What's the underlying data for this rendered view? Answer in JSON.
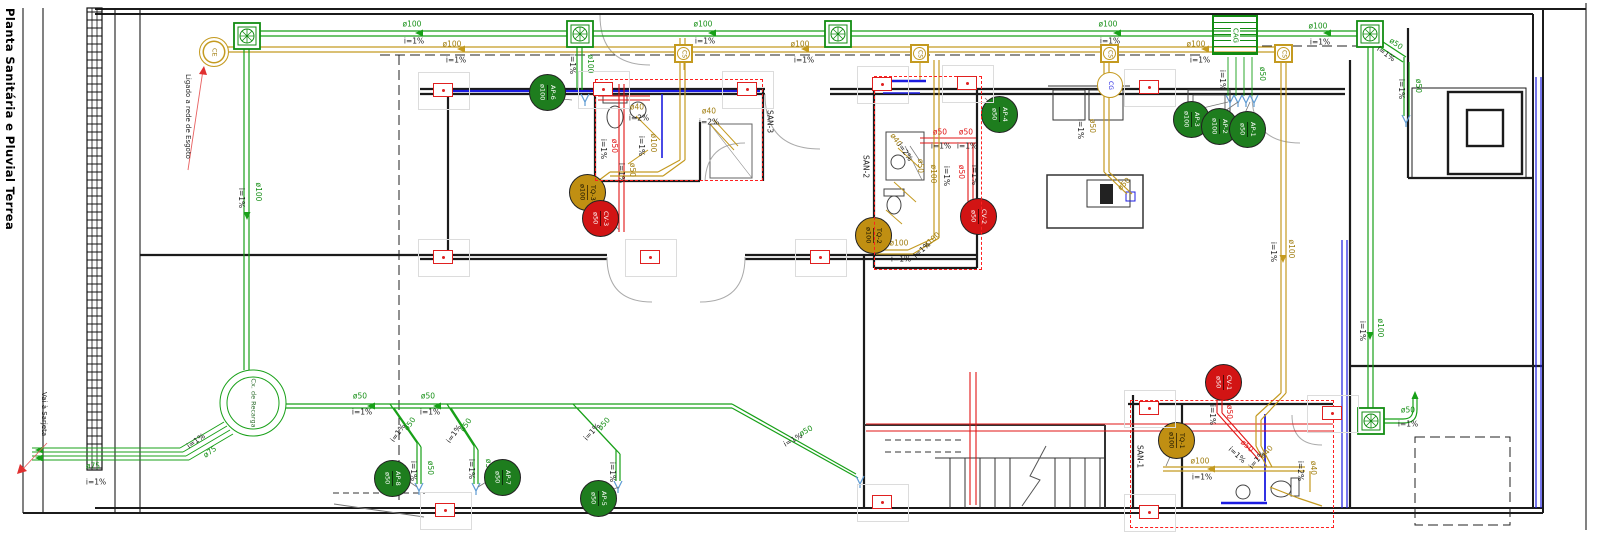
{
  "title": "Planta Sanitária e Pluvial Terrea",
  "notes": {
    "ligado": "Ligado a rede de Esgoto",
    "vai_sarjeta": "Vai à Sarjeta"
  },
  "symbols": {
    "ce": "CE",
    "cag": "CAG",
    "cg": "CG",
    "cs": "CS",
    "cx_recarga": "Cx. de Recarga",
    "cs_boxes": [
      {
        "x": 684
      },
      {
        "x": 920
      },
      {
        "x": 1110
      },
      {
        "x": 1284
      }
    ]
  },
  "rooms": [
    {
      "id": "SAN-3",
      "x1": 595,
      "y1": 79,
      "x2": 763,
      "y2": 181,
      "lx": 766,
      "ly": 110
    },
    {
      "id": "SAN-2",
      "x1": 874,
      "y1": 76,
      "x2": 982,
      "y2": 270,
      "lx": 862,
      "ly": 155
    },
    {
      "id": "SAN-1",
      "x1": 1130,
      "y1": 400,
      "x2": 1334,
      "y2": 528,
      "lx": 1136,
      "ly": 445
    }
  ],
  "badges": [
    {
      "id": "AP-6",
      "dia": "ø100",
      "kind": "ap",
      "x": 547,
      "y": 92
    },
    {
      "id": "AP-4",
      "dia": "ø50",
      "kind": "ap",
      "x": 999,
      "y": 114
    },
    {
      "id": "AP-3",
      "dia": "ø100",
      "kind": "ap",
      "x": 1191,
      "y": 119
    },
    {
      "id": "AP-2",
      "dia": "ø100",
      "kind": "ap",
      "x": 1219,
      "y": 126
    },
    {
      "id": "AP-1",
      "dia": "ø50",
      "kind": "ap",
      "x": 1247,
      "y": 129
    },
    {
      "id": "AP-8",
      "dia": "ø50",
      "kind": "ap",
      "x": 392,
      "y": 478
    },
    {
      "id": "AP-7",
      "dia": "ø50",
      "kind": "ap",
      "x": 502,
      "y": 477
    },
    {
      "id": "AP-5",
      "dia": "ø50",
      "kind": "ap",
      "x": 598,
      "y": 498
    },
    {
      "id": "TQ-3",
      "dia": "ø100",
      "kind": "tq",
      "x": 587,
      "y": 192
    },
    {
      "id": "TQ-2",
      "dia": "ø100",
      "kind": "tq",
      "x": 873,
      "y": 235
    },
    {
      "id": "TQ-1",
      "dia": "ø100",
      "kind": "tq",
      "x": 1176,
      "y": 440
    },
    {
      "id": "CV-3",
      "dia": "ø50",
      "kind": "cv",
      "x": 600,
      "y": 218
    },
    {
      "id": "CV-2",
      "dia": "ø50",
      "kind": "cv",
      "x": 978,
      "y": 216
    },
    {
      "id": "CV-1",
      "dia": "ø50",
      "kind": "cv",
      "x": 1223,
      "y": 382
    }
  ],
  "markers": [
    {
      "x": 443,
      "y": 90
    },
    {
      "x": 1149,
      "y": 87
    },
    {
      "x": 443,
      "y": 257
    },
    {
      "x": 650,
      "y": 257
    },
    {
      "x": 820,
      "y": 257
    },
    {
      "x": 603,
      "y": 89
    },
    {
      "x": 747,
      "y": 89
    },
    {
      "x": 882,
      "y": 84
    },
    {
      "x": 967,
      "y": 83
    },
    {
      "x": 1149,
      "y": 408
    },
    {
      "x": 1332,
      "y": 413
    },
    {
      "x": 1149,
      "y": 512
    },
    {
      "x": 882,
      "y": 502
    },
    {
      "x": 445,
      "y": 510
    }
  ],
  "labels": [
    {
      "t": "ø100",
      "x": 412,
      "y": 24,
      "r": 0,
      "c": "g"
    },
    {
      "t": "i=1%",
      "x": 414,
      "y": 41,
      "r": 0,
      "c": "k"
    },
    {
      "t": "ø100",
      "x": 703,
      "y": 24,
      "r": 0,
      "c": "g"
    },
    {
      "t": "i=1%",
      "x": 705,
      "y": 41,
      "r": 0,
      "c": "k"
    },
    {
      "t": "ø100",
      "x": 1108,
      "y": 24,
      "r": 0,
      "c": "g"
    },
    {
      "t": "i=1%",
      "x": 1110,
      "y": 41,
      "r": 0,
      "c": "k"
    },
    {
      "t": "ø100",
      "x": 1318,
      "y": 26,
      "r": 0,
      "c": "g"
    },
    {
      "t": "i=1%",
      "x": 1320,
      "y": 42,
      "r": 0,
      "c": "k"
    },
    {
      "t": "ø100",
      "x": 452,
      "y": 44,
      "r": 0,
      "c": "y"
    },
    {
      "t": "i=1%",
      "x": 456,
      "y": 60,
      "r": 0,
      "c": "k"
    },
    {
      "t": "ø100",
      "x": 800,
      "y": 44,
      "r": 0,
      "c": "y"
    },
    {
      "t": "i=1%",
      "x": 804,
      "y": 60,
      "r": 0,
      "c": "k"
    },
    {
      "t": "ø100",
      "x": 1196,
      "y": 44,
      "r": 0,
      "c": "y"
    },
    {
      "t": "i=1%",
      "x": 1200,
      "y": 60,
      "r": 0,
      "c": "k"
    },
    {
      "t": "i=1%",
      "x": 572,
      "y": 64,
      "r": 90,
      "c": "k"
    },
    {
      "t": "ø100",
      "x": 590,
      "y": 64,
      "r": 90,
      "c": "g"
    },
    {
      "t": "i=1%",
      "x": 1222,
      "y": 80,
      "r": 90,
      "c": "k"
    },
    {
      "t": "ø50",
      "x": 1262,
      "y": 74,
      "r": 90,
      "c": "g"
    },
    {
      "t": "ø100",
      "x": 258,
      "y": 192,
      "r": 90,
      "c": "g"
    },
    {
      "t": "i=1%",
      "x": 241,
      "y": 198,
      "r": 90,
      "c": "k"
    },
    {
      "t": "ø100",
      "x": 1380,
      "y": 328,
      "r": 90,
      "c": "g"
    },
    {
      "t": "i=1%",
      "x": 1362,
      "y": 331,
      "r": 90,
      "c": "k"
    },
    {
      "t": "ø50",
      "x": 1396,
      "y": 44,
      "r": 35,
      "c": "g"
    },
    {
      "t": "i=1%",
      "x": 1386,
      "y": 54,
      "r": 35,
      "c": "k"
    },
    {
      "t": "ø50",
      "x": 1418,
      "y": 86,
      "r": 90,
      "c": "g"
    },
    {
      "t": "i=1%",
      "x": 1401,
      "y": 89,
      "r": 90,
      "c": "k"
    },
    {
      "t": "ø50",
      "x": 1408,
      "y": 410,
      "r": 0,
      "c": "g"
    },
    {
      "t": "i=1%",
      "x": 1408,
      "y": 424,
      "r": 0,
      "c": "k"
    },
    {
      "t": "ø75",
      "x": 93,
      "y": 466,
      "r": 0,
      "c": "g"
    },
    {
      "t": "i=1%",
      "x": 96,
      "y": 482,
      "r": 0,
      "c": "k"
    },
    {
      "t": "i=1%",
      "x": 196,
      "y": 441,
      "r": -35,
      "c": "k"
    },
    {
      "t": "ø75",
      "x": 210,
      "y": 452,
      "r": -35,
      "c": "g"
    },
    {
      "t": "ø50",
      "x": 360,
      "y": 396,
      "r": 0,
      "c": "g"
    },
    {
      "t": "i=1%",
      "x": 362,
      "y": 412,
      "r": 0,
      "c": "k"
    },
    {
      "t": "ø50",
      "x": 428,
      "y": 396,
      "r": 0,
      "c": "g"
    },
    {
      "t": "i=1%",
      "x": 430,
      "y": 412,
      "r": 0,
      "c": "k"
    },
    {
      "t": "ø50",
      "x": 410,
      "y": 424,
      "r": -55,
      "c": "g"
    },
    {
      "t": "i=1%",
      "x": 398,
      "y": 433,
      "r": -55,
      "c": "k"
    },
    {
      "t": "ø50",
      "x": 466,
      "y": 425,
      "r": -55,
      "c": "g"
    },
    {
      "t": "i=1%",
      "x": 454,
      "y": 434,
      "r": -55,
      "c": "k"
    },
    {
      "t": "ø50",
      "x": 604,
      "y": 424,
      "r": -48,
      "c": "g"
    },
    {
      "t": "i=1%",
      "x": 592,
      "y": 432,
      "r": -48,
      "c": "k"
    },
    {
      "t": "ø50",
      "x": 430,
      "y": 468,
      "r": 90,
      "c": "g"
    },
    {
      "t": "i=1%",
      "x": 413,
      "y": 471,
      "r": 90,
      "c": "k"
    },
    {
      "t": "ø50",
      "x": 488,
      "y": 466,
      "r": 90,
      "c": "g"
    },
    {
      "t": "i=1%",
      "x": 471,
      "y": 469,
      "r": 90,
      "c": "k"
    },
    {
      "t": "i=1%",
      "x": 612,
      "y": 472,
      "r": 90,
      "c": "k"
    },
    {
      "t": "ø50",
      "x": 806,
      "y": 431,
      "r": -29,
      "c": "g"
    },
    {
      "t": "i=1%",
      "x": 793,
      "y": 440,
      "r": -29,
      "c": "k"
    },
    {
      "t": "ø40",
      "x": 637,
      "y": 107,
      "r": 0,
      "c": "y"
    },
    {
      "t": "i=2%",
      "x": 639,
      "y": 118,
      "r": 0,
      "c": "k"
    },
    {
      "t": "ø40",
      "x": 709,
      "y": 111,
      "r": 0,
      "c": "y"
    },
    {
      "t": "i=2%",
      "x": 709,
      "y": 122,
      "r": 0,
      "c": "k"
    },
    {
      "t": "ø50",
      "x": 614,
      "y": 146,
      "r": 90,
      "c": "r"
    },
    {
      "t": "i=1%",
      "x": 603,
      "y": 149,
      "r": 90,
      "c": "k"
    },
    {
      "t": "ø100",
      "x": 653,
      "y": 143,
      "r": 90,
      "c": "y"
    },
    {
      "t": "i=1%",
      "x": 641,
      "y": 146,
      "r": 90,
      "c": "k"
    },
    {
      "t": "ø50",
      "x": 632,
      "y": 170,
      "r": 90,
      "c": "y"
    },
    {
      "t": "i=1%",
      "x": 621,
      "y": 173,
      "r": 90,
      "c": "k"
    },
    {
      "t": "ø50",
      "x": 940,
      "y": 132,
      "r": 0,
      "c": "r"
    },
    {
      "t": "i=1%",
      "x": 941,
      "y": 146,
      "r": 0,
      "c": "k"
    },
    {
      "t": "ø50",
      "x": 966,
      "y": 132,
      "r": 0,
      "c": "r"
    },
    {
      "t": "i=1%",
      "x": 967,
      "y": 146,
      "r": 0,
      "c": "k"
    },
    {
      "t": "ø100",
      "x": 933,
      "y": 174,
      "r": 90,
      "c": "y"
    },
    {
      "t": "i=1%",
      "x": 946,
      "y": 176,
      "r": 90,
      "c": "k"
    },
    {
      "t": "ø50",
      "x": 920,
      "y": 166,
      "r": 90,
      "c": "y"
    },
    {
      "t": "ø40",
      "x": 896,
      "y": 140,
      "r": 55,
      "c": "y"
    },
    {
      "t": "i=2%",
      "x": 905,
      "y": 152,
      "r": 55,
      "c": "k"
    },
    {
      "t": "ø50",
      "x": 961,
      "y": 172,
      "r": 90,
      "c": "r"
    },
    {
      "t": "i=1%",
      "x": 974,
      "y": 175,
      "r": 90,
      "c": "k"
    },
    {
      "t": "ø100",
      "x": 899,
      "y": 243,
      "r": 0,
      "c": "y"
    },
    {
      "t": "i=1%",
      "x": 901,
      "y": 259,
      "r": 0,
      "c": "k"
    },
    {
      "t": "ø100",
      "x": 932,
      "y": 240,
      "r": -42,
      "c": "y"
    },
    {
      "t": "i=1%",
      "x": 922,
      "y": 250,
      "r": -42,
      "c": "k"
    },
    {
      "t": "ø50",
      "x": 1092,
      "y": 126,
      "r": 90,
      "c": "y"
    },
    {
      "t": "i=1%",
      "x": 1080,
      "y": 129,
      "r": 90,
      "c": "k"
    },
    {
      "t": "ø50",
      "x": 1124,
      "y": 184,
      "r": -45,
      "c": "y"
    },
    {
      "t": "i=1%",
      "x": 1273,
      "y": 252,
      "r": 90,
      "c": "k"
    },
    {
      "t": "ø100",
      "x": 1291,
      "y": 249,
      "r": 90,
      "c": "y"
    },
    {
      "t": "ø50",
      "x": 1229,
      "y": 412,
      "r": 90,
      "c": "r"
    },
    {
      "t": "i=1%",
      "x": 1212,
      "y": 415,
      "r": 90,
      "c": "k"
    },
    {
      "t": "ø50",
      "x": 1247,
      "y": 446,
      "r": 42,
      "c": "r"
    },
    {
      "t": "i=1%",
      "x": 1237,
      "y": 455,
      "r": 42,
      "c": "k"
    },
    {
      "t": "ø100",
      "x": 1200,
      "y": 461,
      "r": 0,
      "c": "y"
    },
    {
      "t": "i=1%",
      "x": 1202,
      "y": 477,
      "r": 0,
      "c": "k"
    },
    {
      "t": "ø40",
      "x": 1313,
      "y": 468,
      "r": 90,
      "c": "y"
    },
    {
      "t": "i=2%",
      "x": 1300,
      "y": 471,
      "r": 90,
      "c": "k"
    },
    {
      "t": "ø40",
      "x": 1267,
      "y": 452,
      "r": -50,
      "c": "y"
    },
    {
      "t": "i=1%",
      "x": 1257,
      "y": 460,
      "r": -50,
      "c": "k"
    }
  ]
}
